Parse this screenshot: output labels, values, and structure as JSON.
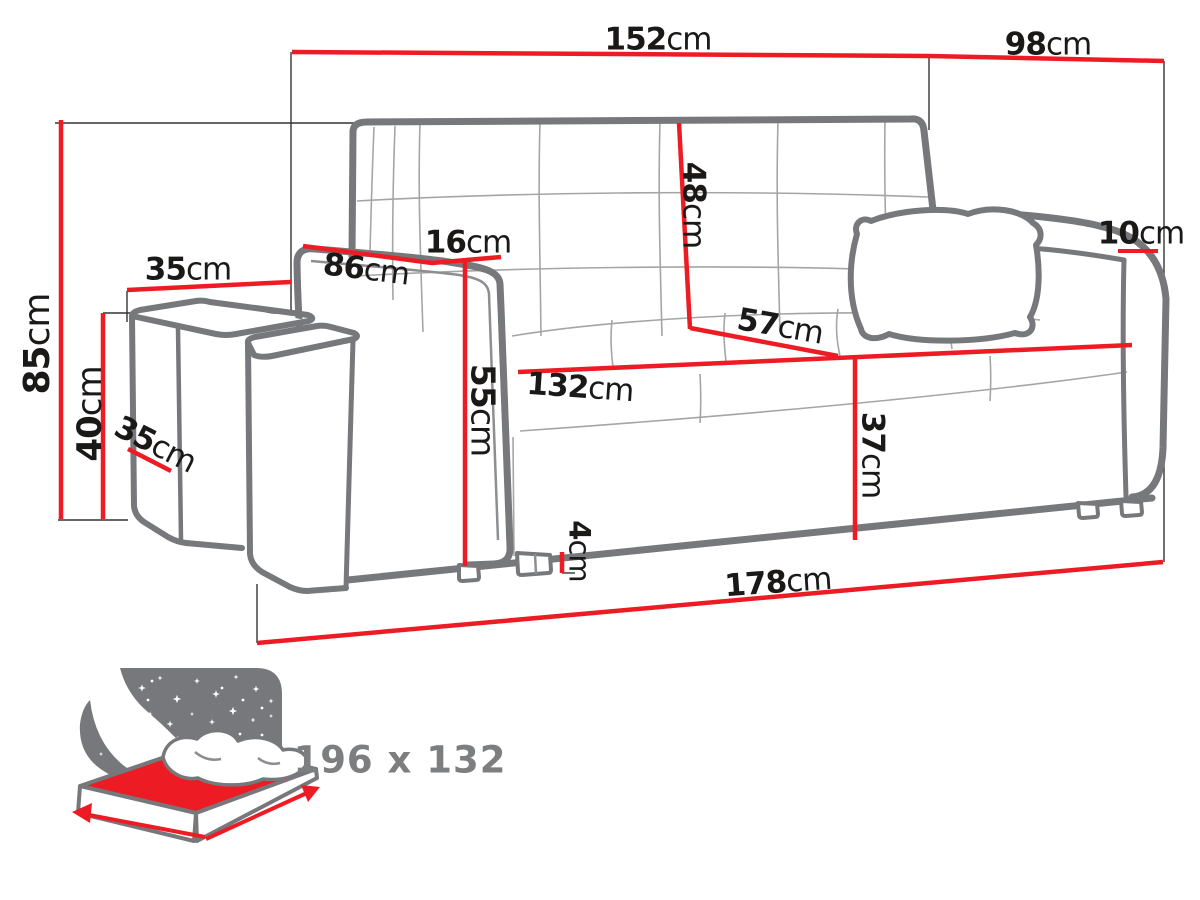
{
  "diagram": {
    "subject": "sofa-bed with two poufs, dimension drawing",
    "unit": "cm",
    "colors": {
      "dimension_red": "#ed1c24",
      "outline_gray": "#77787b",
      "label_ink": "#1b1917",
      "sleeping_gray": "#7d7e80"
    },
    "icons": {
      "sleeping_function": "bed-night-sky-icon"
    }
  },
  "dimensions": {
    "width_total": {
      "value": "152",
      "unit": "cm"
    },
    "depth_total": {
      "value": "98",
      "unit": "cm"
    },
    "height_total": {
      "value": "85",
      "unit": "cm"
    },
    "pouf_height": {
      "value": "40",
      "unit": "cm"
    },
    "pouf_width": {
      "value": "35",
      "unit": "cm"
    },
    "pouf_depth": {
      "value": "35",
      "unit": "cm"
    },
    "armrest_length": {
      "value": "86",
      "unit": "cm"
    },
    "armrest_width": {
      "value": "16",
      "unit": "cm"
    },
    "armrest_height": {
      "value": "55",
      "unit": "cm"
    },
    "backrest_height": {
      "value": "48",
      "unit": "cm"
    },
    "seat_depth": {
      "value": "57",
      "unit": "cm"
    },
    "seat_width": {
      "value": "132",
      "unit": "cm"
    },
    "seat_height": {
      "value": "37",
      "unit": "cm"
    },
    "armrest_top_drop": {
      "value": "10",
      "unit": "cm"
    },
    "foot_height": {
      "value": "4",
      "unit": "cm"
    },
    "width_front": {
      "value": "178",
      "unit": "cm"
    }
  },
  "sleeping_area": {
    "label": "196 x 132"
  }
}
